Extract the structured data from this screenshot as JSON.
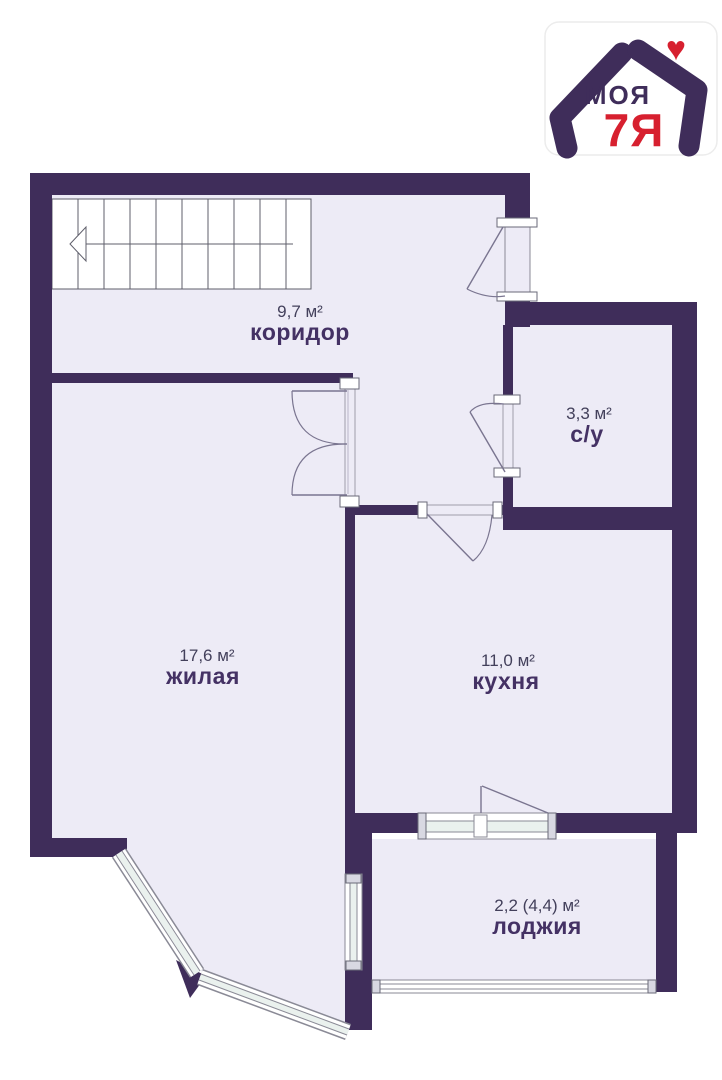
{
  "plan_title": "apartment floor plan",
  "rooms": [
    {
      "id": "corridor",
      "name": "коридор",
      "area": "9,7 м²"
    },
    {
      "id": "bathroom",
      "name": "с/у",
      "area": "3,3 м²"
    },
    {
      "id": "living",
      "name": "жилая",
      "area": "17,6 м²"
    },
    {
      "id": "kitchen",
      "name": "кухня",
      "area": "11,0 м²"
    },
    {
      "id": "loggia",
      "name": "лоджия",
      "area": "2,2 (4,4) м²"
    }
  ],
  "logo": {
    "text_top": "МОЯ",
    "text_bottom": "7Я",
    "heart_icon": "♥"
  },
  "colors": {
    "wall": "#3f2d5a",
    "floor": "#edebf6",
    "room_name_text": "#443164",
    "area_text": "#43405b",
    "logo_red": "#d7202f",
    "window_glass": "#eaf1ee",
    "frame_line": "#8a8a96"
  }
}
